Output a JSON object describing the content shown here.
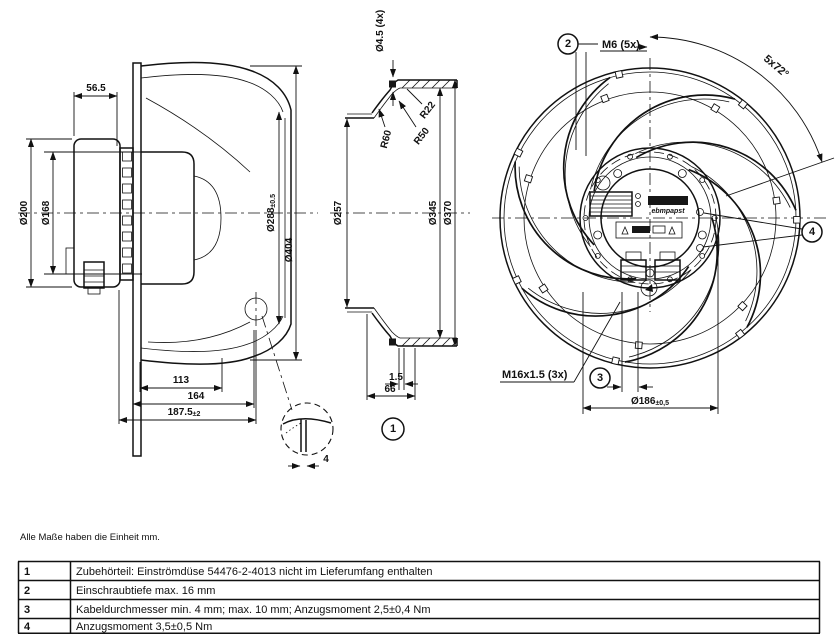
{
  "note": "Alle Maße haben die Einheit mm.",
  "table": {
    "rows": [
      {
        "num": "1",
        "text": "Zubehörteil: Einströmdüse 54476-2-4013 nicht im Lieferumfang enthalten"
      },
      {
        "num": "2",
        "text": "Einschraubtiefe max. 16 mm"
      },
      {
        "num": "3",
        "text": "Kabeldurchmesser min. 4 mm; max. 10 mm; Anzugsmoment 2,5±0,4 Nm"
      },
      {
        "num": "4",
        "text": "Anzugsmoment 3,5±0,5 Nm"
      }
    ]
  },
  "side_view": {
    "depth_56": "56.5",
    "motor_dia": "Ø200",
    "spigot_dia": "Ø168",
    "outlet_dia": "Ø288",
    "outlet_dia_tol": "±0.5",
    "max_dia": "Ø404",
    "dim_113": "113",
    "dim_164": "164",
    "total_depth": "187.5",
    "total_depth_tol": "±2",
    "detail_dim_4": "4"
  },
  "section_view": {
    "hole_dia": "Ø4.5 (4x)",
    "r22": "R22",
    "r50": "R50",
    "r60": "R60",
    "inner_dia": "Ø257",
    "bolt_dia": "Ø345",
    "outer_dia": "Ø370",
    "lip": "1.5",
    "depth_66": "66",
    "callout_1": "1"
  },
  "front_view": {
    "callout_2": "2",
    "screw_m6": "M6 (5x)",
    "angle": "5x72°",
    "callout_4": "4",
    "thread_m16": "M16x1.5 (3x)",
    "callout_3": "3",
    "pitch_dia": "Ø186",
    "pitch_dia_tol": "±0,5",
    "logo": "ebmpapst"
  }
}
